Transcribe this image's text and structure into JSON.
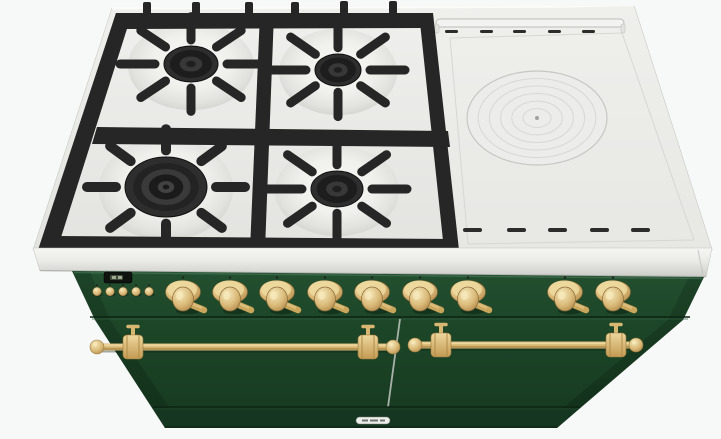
{
  "scene": {
    "label": "range-cooker-3d-render",
    "colors": {
      "bg": "#f7f8f8",
      "steel_light": "#f4f4f2",
      "steel": "#e9e9e6",
      "steel_dark": "#cfcfcc",
      "steel_edge": "#bfbfbc",
      "iron": "#262626",
      "iron_dark": "#151515",
      "iron_light": "#3a3a3a",
      "green_top": "#235030",
      "green": "#1d4628",
      "green_dark": "#163920",
      "green_plinth": "#153620",
      "green_line": "#0d2414",
      "brass": "#d7b672",
      "brass_light": "#f2dfa8",
      "brass_dark": "#9c7a3e",
      "brass_deep": "#8a6a38",
      "display_bg": "#0f1411",
      "badge_bg": "#eceeea",
      "vent": "#2c2c2a"
    },
    "cooktop": {
      "burners": [
        {
          "name": "back-left-burner",
          "type": "standard",
          "cx": 191,
          "cy": 64,
          "cap_rx": 27,
          "cap_ry": 18
        },
        {
          "name": "back-right-burner",
          "type": "standard",
          "cx": 338,
          "cy": 70,
          "cap_rx": 23,
          "cap_ry": 16
        },
        {
          "name": "front-left-wok-burner",
          "type": "wok",
          "cx": 166,
          "cy": 187,
          "cap_rx": 41,
          "cap_ry": 30
        },
        {
          "name": "front-right-burner",
          "type": "standard",
          "cx": 337,
          "cy": 189,
          "cap_rx": 26,
          "cap_ry": 18
        }
      ],
      "vents_top": {
        "y": 30,
        "w": 13,
        "h": 3,
        "xs": [
          445,
          480,
          513,
          548,
          582
        ]
      },
      "vents_bottom": {
        "y": 228,
        "w": 19,
        "h": 4,
        "xs": [
          463,
          507,
          548,
          590,
          631
        ]
      },
      "simmer_plate": {
        "cx": 537,
        "cy": 118,
        "rx": 70,
        "ry": 47,
        "ring_fractions": [
          0.84,
          0.68,
          0.52,
          0.36,
          0.2
        ]
      }
    },
    "controls": {
      "knob_xs": [
        183,
        230,
        277,
        325,
        372,
        420,
        468,
        565,
        613
      ],
      "knob_y": 292,
      "button_xs": [
        97,
        110,
        123,
        136,
        149
      ],
      "button_y": 291.5,
      "display": {
        "x": 104,
        "y": 272,
        "w": 28,
        "h": 11
      }
    },
    "body": {
      "rails": [
        {
          "y": 347,
          "balls": [
            97,
            393
          ],
          "brackets": [
            133,
            368
          ]
        },
        {
          "y": 345,
          "balls": [
            415,
            636
          ],
          "brackets": [
            441,
            616
          ]
        }
      ]
    }
  }
}
